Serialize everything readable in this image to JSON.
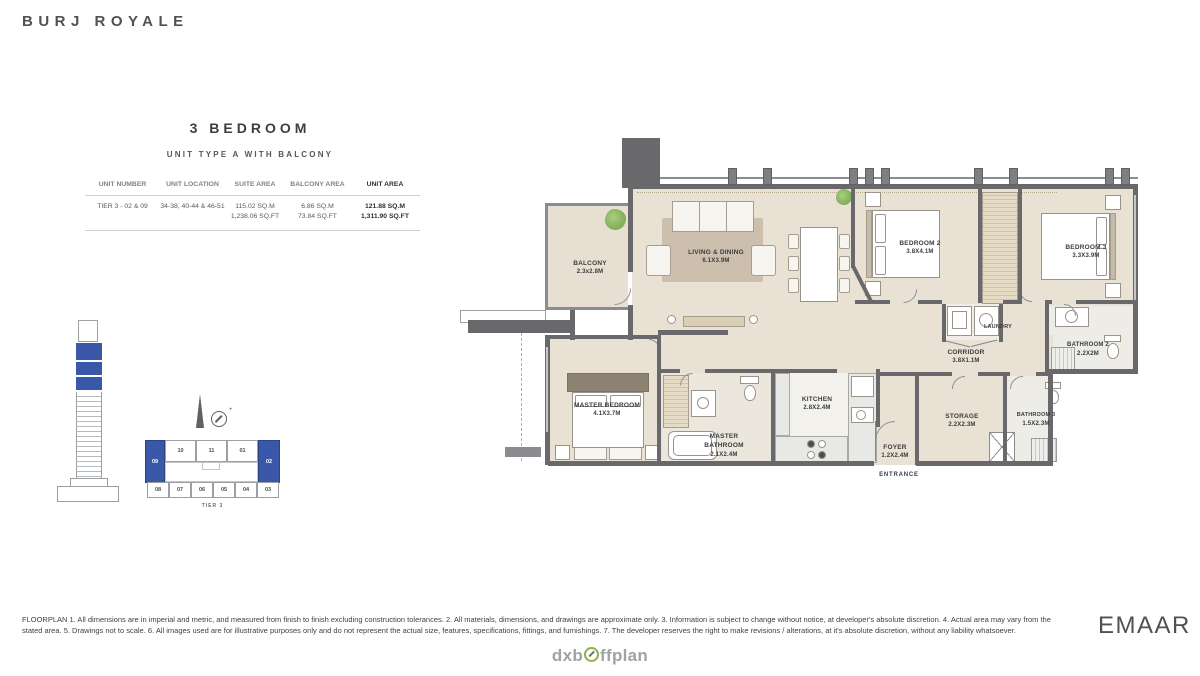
{
  "brand": {
    "title": "BURJ ROYALE",
    "developer": "EMAAR"
  },
  "watermark": {
    "text_left": "dxb",
    "text_right": "ffplan"
  },
  "unit": {
    "heading": "3 BEDROOM",
    "subheading": "UNIT TYPE A WITH BALCONY"
  },
  "table": {
    "headers": [
      "UNIT NUMBER",
      "UNIT LOCATION",
      "SUITE AREA",
      "BALCONY AREA",
      "UNIT AREA"
    ],
    "row": {
      "unit_number": "TIER 3 - 02 & 09",
      "unit_location": "34-38, 40-44 & 46-51",
      "suite_sqm": "115.02 SQ.M",
      "suite_sqft": "1,238.06 SQ.FT",
      "balcony_sqm": "6.86 SQ.M",
      "balcony_sqft": "73.84 SQ.FT",
      "unit_sqm": "121.88 SQ.M",
      "unit_sqft": "1,311.90 SQ.FT"
    }
  },
  "key_plan": {
    "tier_label": "TIER 3",
    "highlight_left": "09",
    "highlight_right": "02",
    "top_units": [
      "10",
      "11",
      "01"
    ],
    "bottom_units": [
      "08",
      "07",
      "06",
      "05",
      "04",
      "03"
    ],
    "highlight_color": "#3a57a8"
  },
  "floorplan": {
    "rooms": {
      "balcony": {
        "name": "BALCONY",
        "dims": "2.3x2.8M"
      },
      "living": {
        "name": "LIVING & DINING",
        "dims": "6.1X3.9M"
      },
      "bedroom2": {
        "name": "BEDROOM 2",
        "dims": "3.8X4.1M"
      },
      "bedroom3": {
        "name": "BEDROOM 3",
        "dims": "3.3X3.9M"
      },
      "laundry": {
        "name": "LAUNDRY"
      },
      "corridor": {
        "name": "CORRIDOR",
        "dims": "3.8X1.1M"
      },
      "bathroom2": {
        "name": "BATHROOM 2",
        "dims": "2.2X2M"
      },
      "master_bedroom": {
        "name": "MASTER BEDROOM",
        "dims": "4.1X3.7M"
      },
      "master_bathroom": {
        "name": "MASTER BATHROOM",
        "dims": "2.1X2.4M"
      },
      "kitchen": {
        "name": "KITCHEN",
        "dims": "2.8X2.4M"
      },
      "storage": {
        "name": "STORAGE",
        "dims": "2.2X2.3M"
      },
      "bathroom3": {
        "name": "BATHROOM 3",
        "dims": "1.5X2.3M"
      },
      "foyer": {
        "name": "FOYER",
        "dims": "1.2X2.4M"
      },
      "entrance": {
        "name": "ENTRANCE"
      }
    }
  },
  "colors": {
    "accent_blue": "#3a57a8",
    "wall_gray": "#69696b",
    "floor_beige": "#e9e1d3",
    "logo_green": "#8cb43c"
  },
  "disclaimer": "FLOORPLAN 1. All dimensions are in imperial and metric, and measured from finish to finish excluding construction tolerances. 2. All materials, dimensions, and drawings are approximate only. 3. Information is subject to change without notice, at developer's absolute discretion. 4. Actual area may vary from the stated area. 5. Drawings not to scale. 6. All images used are for illustrative purposes only and do not represent the actual size, features, specifications, fittings, and furnishings. 7. The developer reserves the right to make revisions / alterations, at it's absolute discretion, without any liability whatsoever."
}
